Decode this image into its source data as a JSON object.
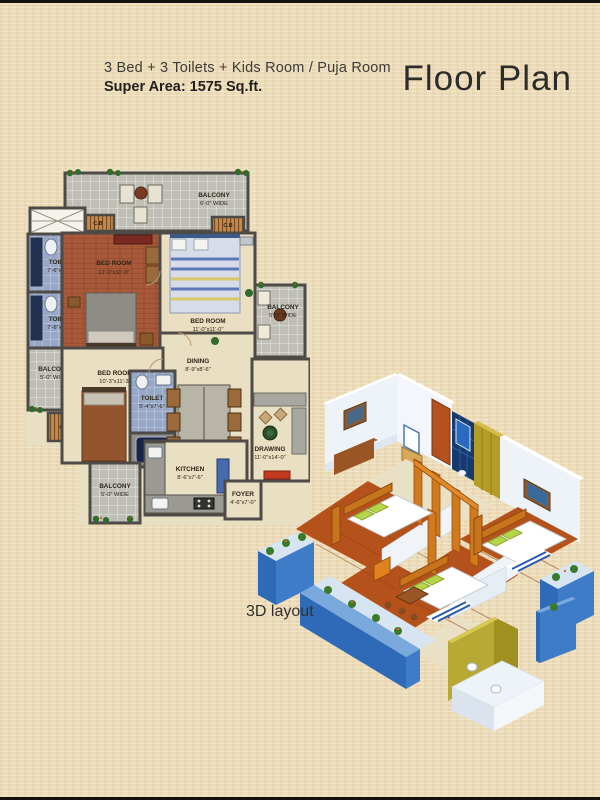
{
  "header": {
    "line1": "3 Bed + 3 Toilets + Kids Room / Puja Room",
    "line2": "Super Area: 1575 Sq.ft.",
    "title": "Floor Plan"
  },
  "plan2d": {
    "balcony_top": {
      "name": "BALCONY",
      "dims": "6'-0\" WIDE"
    },
    "balcony_left": {
      "name": "BALCONY",
      "dims": "5'-0\" WIDE"
    },
    "balcony_right": {
      "name": "BALCONY",
      "dims": "5'-0\" WIDE"
    },
    "balcony_bottom": {
      "name": "BALCONY",
      "dims": "5'-0\" WIDE"
    },
    "bedroom1": {
      "name": "BED ROOM",
      "dims": "12'-0\"x11'-0\""
    },
    "bedroom2": {
      "name": "BED ROOM",
      "dims": "11'-0\"x11'-0\""
    },
    "bedroom3": {
      "name": "BED ROOM",
      "dims": "10'-3\"x11'-3\""
    },
    "toilet1": {
      "name": "TOILET",
      "dims": "7'-6\"x5'-0\""
    },
    "toilet2": {
      "name": "TOILET",
      "dims": "7'-6\"x5'-0\""
    },
    "toilet3": {
      "name": "TOILET",
      "dims": "5'-4\"x7'-6\""
    },
    "dining": {
      "name": "DINING",
      "dims": "8'-9\"x8'-6\""
    },
    "drawing": {
      "name": "DRAWING",
      "dims": "11'-0\"x14'-0\""
    },
    "kitchen": {
      "name": "KITCHEN",
      "dims": "8'-6\"x7'-6\""
    },
    "foyer": {
      "name": "FOYER",
      "dims": "4'-6\"x7'-0\""
    },
    "cb": "C.B"
  },
  "layout3d": {
    "caption": "3D layout"
  },
  "colors": {
    "page_bg": "#eddcb8",
    "wall": "#4e4a46",
    "tile_gray": "#bfbfb8",
    "tile_blue": "#96a7c8",
    "wood_floor": "#a8593a",
    "balcony_blue_3d": "#2f6ab8",
    "floor_orange_3d": "#b5521c",
    "accent_gold_3d": "#b59c28"
  }
}
